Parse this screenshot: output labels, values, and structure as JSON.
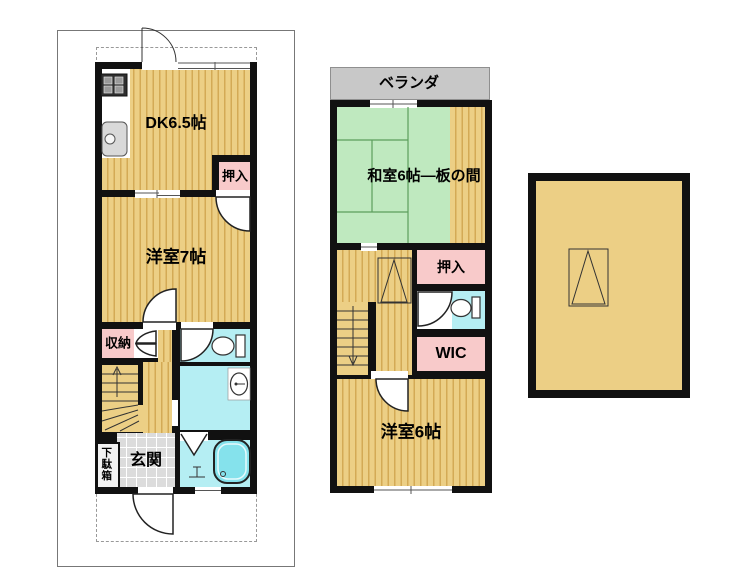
{
  "floor1": {
    "dk_label": "DK6.5帖",
    "closet_label": "押入",
    "western_room_label": "洋室7帖",
    "storage_label": "収納",
    "entrance_label": "玄関",
    "shoe_box_label": "下駄箱"
  },
  "floor2": {
    "veranda_label": "ベランダ",
    "japanese_room_label": "和室6帖―板の間",
    "closet_label": "押入",
    "wic_label": "WIC",
    "western_room_label": "洋室6帖"
  },
  "icons": {
    "gas_stove": "gas-stove-icon",
    "kitchen_sink": "kitchen-sink-icon",
    "toilet_1f": "toilet-icon",
    "toilet_2f": "toilet-icon",
    "washbasin": "washbasin-icon",
    "bathtub": "bathtub-icon",
    "bath_faucet": "faucet-icon",
    "stairs_up": "stairs-up-arrow",
    "stairs_down": "stairs-down-arrow",
    "door_swing": "door-swing-arc",
    "folding_door": "folding-door-icon",
    "ladder_symbol": "attic-ladder-symbol"
  },
  "colors": {
    "wall": "#111111",
    "floor_base": "#eccf85",
    "floor_stripe": "#d3aa55",
    "tatami_green": "#bfe9bf",
    "tatami_line": "#5c9e5c",
    "closet_pink": "#f8caca",
    "water_cyan": "#b5eef3",
    "bathtub_cyan": "#85e2ec",
    "veranda_gray": "#c8c8c8",
    "entrance_tile_gray": "#dcdcdc"
  }
}
